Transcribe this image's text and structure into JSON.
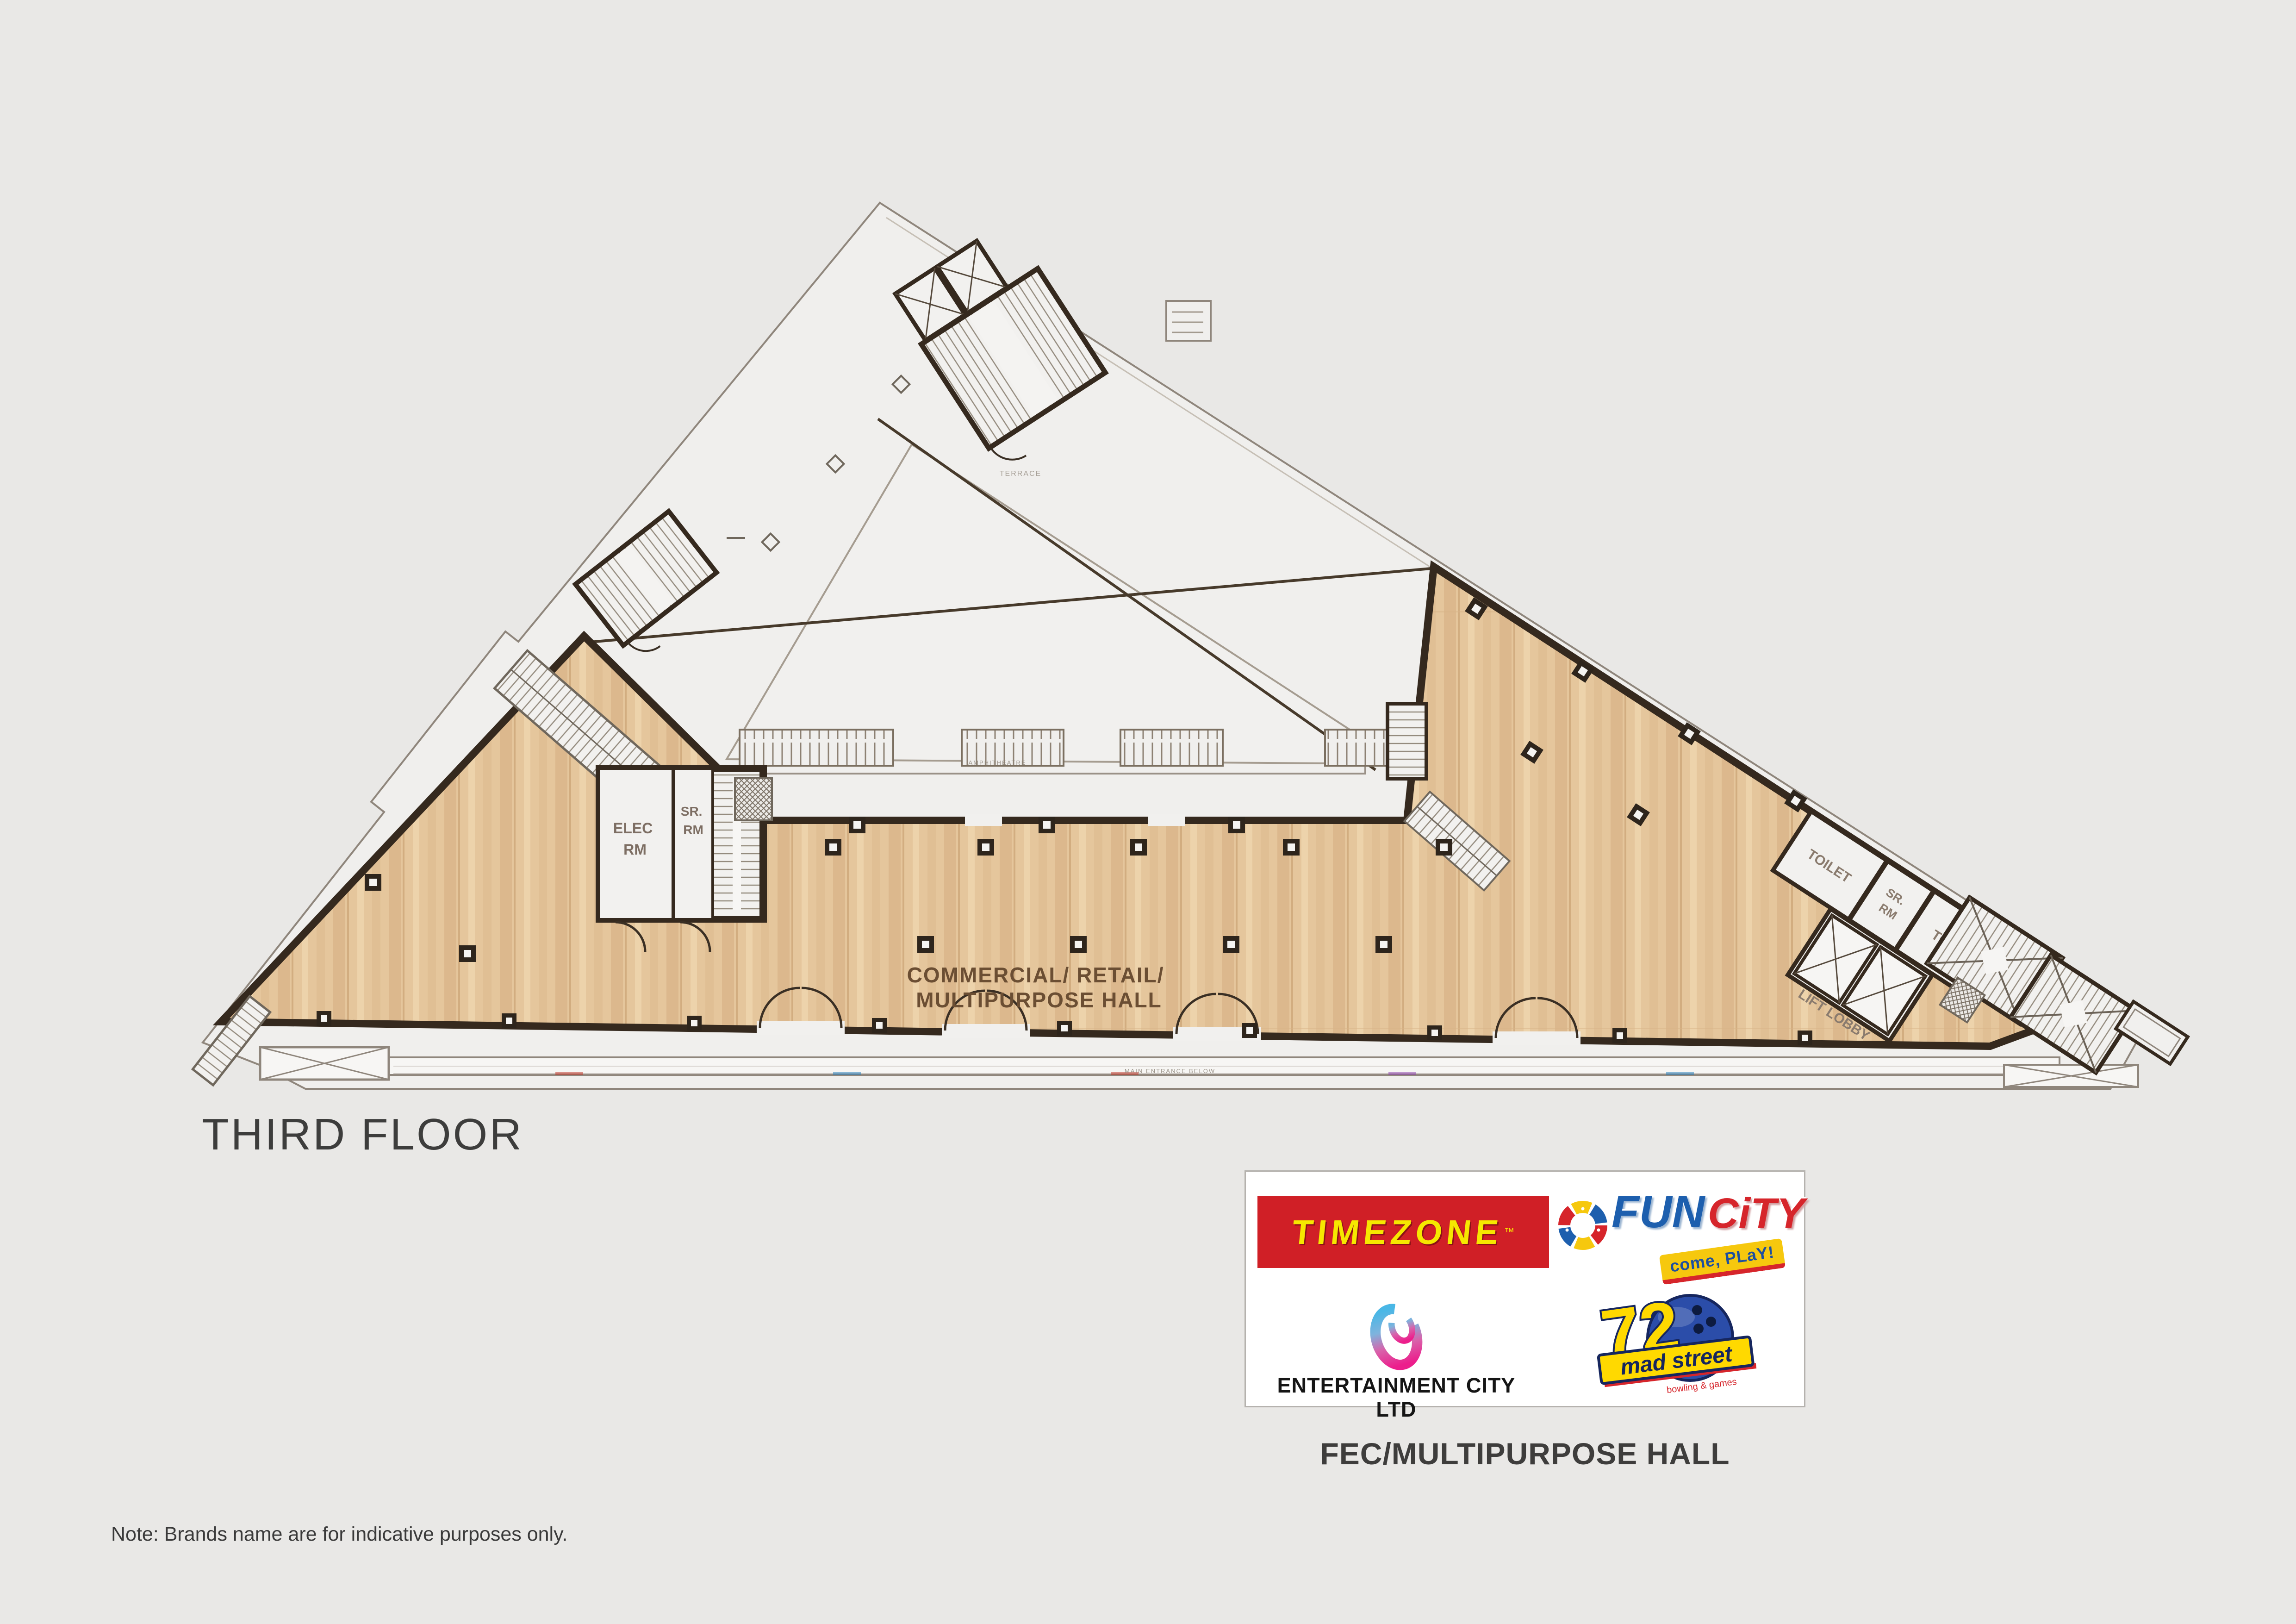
{
  "title": {
    "floor": "THIRD FLOOR"
  },
  "note": {
    "text": "Note: Brands name are for indicative purposes only."
  },
  "legend": {
    "caption": "FEC/MULTIPURPOSE HALL"
  },
  "brands": {
    "timezone": {
      "name": "TIMEZONE",
      "tm": "™"
    },
    "fun_city": {
      "fun": "FUN",
      "city": "CiTY",
      "tagline": "come, PLaY!"
    },
    "entertainment_city": {
      "name": "ENTERTAINMENT CITY LTD"
    },
    "mad_street": {
      "number": "72",
      "name": "mad street",
      "tagline": "bowling & games"
    }
  },
  "plan": {
    "hall": {
      "line1": "COMMERCIAL/ RETAIL/",
      "line2": "MULTIPURPOSE HALL"
    },
    "rooms": {
      "elec_rm": {
        "line1": "ELEC",
        "line2": "RM"
      },
      "sr_rm_left": {
        "line1": "SR.",
        "line2": "RM"
      },
      "toilet_a": "TOILET",
      "sr_rm_right": {
        "line1": "SR.",
        "line2": "RM"
      },
      "toilet_b": "TOILET",
      "lift_lobby": "LIFT LOBBY"
    },
    "annotations": {
      "court": "TERRACE",
      "walkway": "AMPHITHEATRE",
      "entrance": "MAIN ENTRANCE BELOW"
    }
  },
  "colors": {
    "background": "#e9e8e6",
    "interior": "#f0efed",
    "floor_wood": "#e5c69c",
    "wall": "#35291e",
    "boundary_line": "#8f867c",
    "label_brown": "#6b4e33",
    "timezone_red": "#d01f26",
    "timezone_yellow": "#f6e800",
    "fun_blue": "#1d5fae",
    "city_red": "#d6252b",
    "tag_yellow": "#f6c80e",
    "ball_blue": "#2b4da9"
  }
}
